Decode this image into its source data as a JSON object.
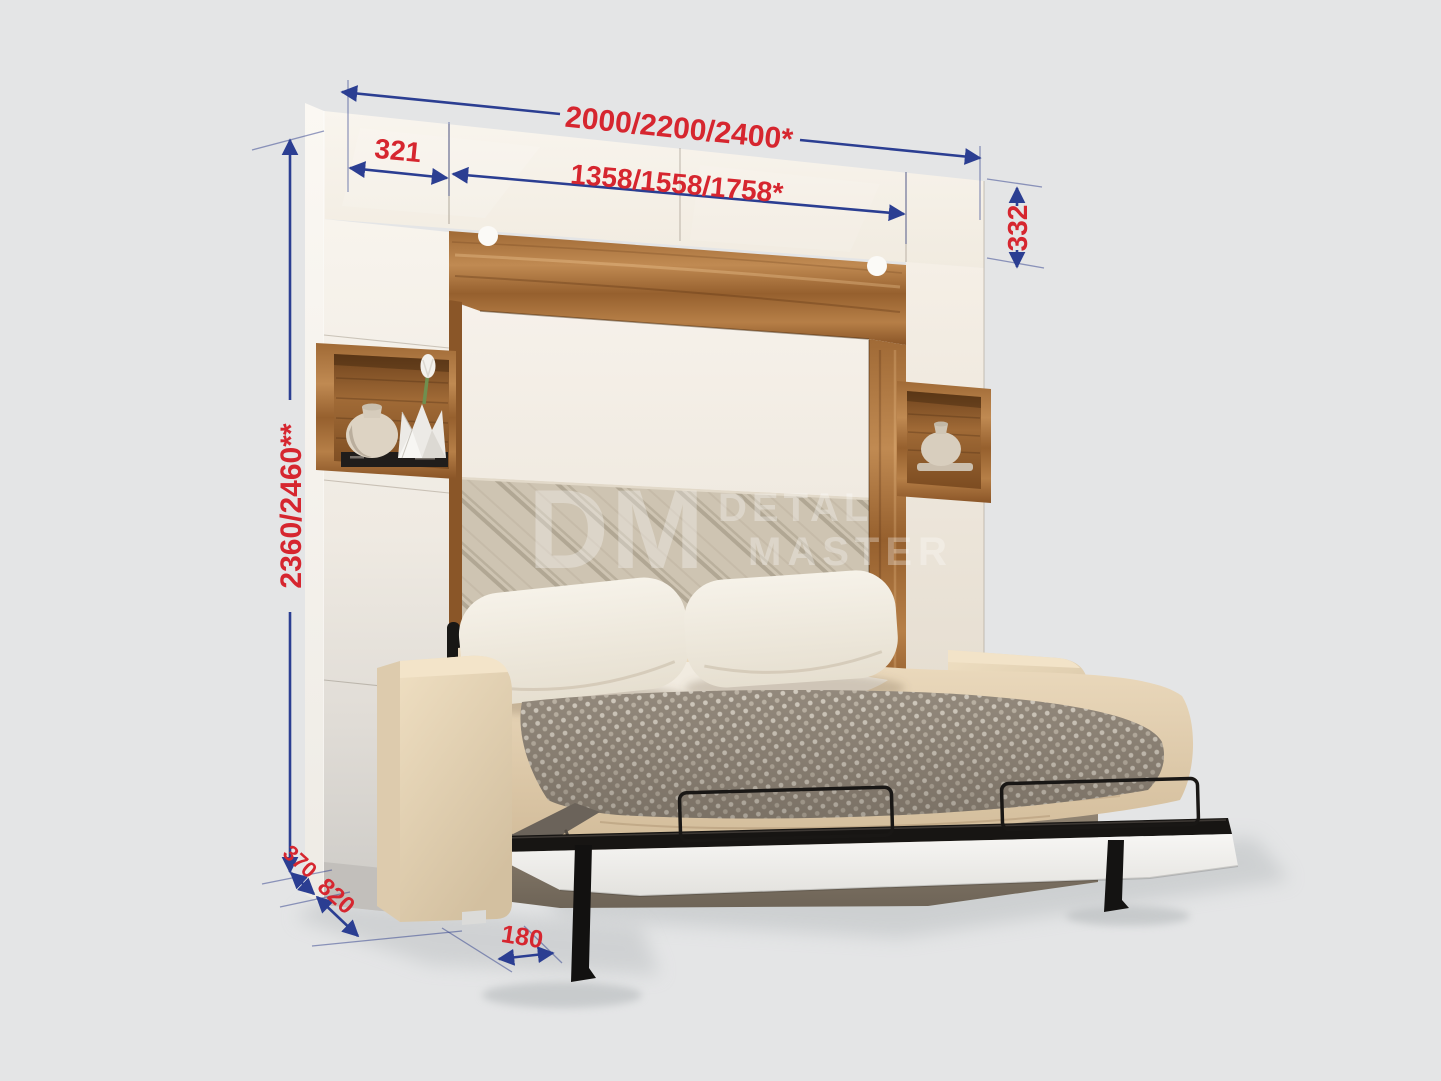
{
  "diagram": {
    "kind": "wall-bed-with-sofa-dimension-diagram",
    "background_color": "#e4e5e6",
    "dimension_line_color": "#2b3e92",
    "dimension_text_color": "#d6262f",
    "wood_color": "#b07c46",
    "cabinet_color": "#f6f1e9",
    "upholstery_color": "#e9d9bd",
    "dimensions": {
      "total_width": "2000/2200/2400*",
      "side_cabinet_width": "321",
      "bed_section_width": "1358/1558/1758*",
      "upper_cabinet_height": "332",
      "total_height": "2360/2460**",
      "cabinet_depth": "370",
      "sofa_depth": "820",
      "leg_offset": "180"
    },
    "watermark": {
      "logo": "DM",
      "line1": "DETAL",
      "line2": "MASTER"
    }
  }
}
